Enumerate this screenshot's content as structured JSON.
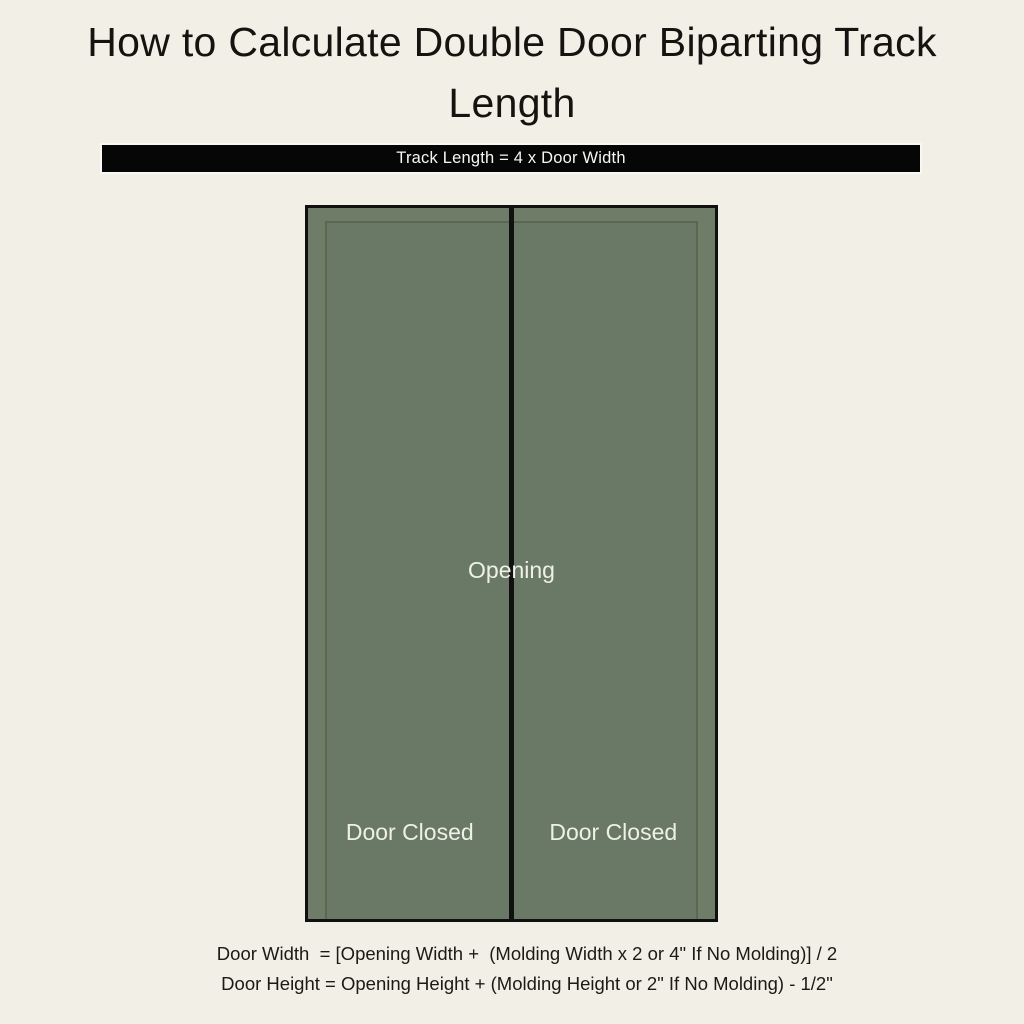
{
  "colors": {
    "page-bg": "#f1efe6",
    "title-color": "#15130f",
    "banner-bg": "#060606",
    "banner-text": "#f7f7f2",
    "door-frame-green": "#6e7c68",
    "door-panel-green": "#6a7965",
    "panel-line-green": "#5a6852",
    "door-outline": "#101010",
    "door-label-color": "#eff0e7",
    "formula-color": "#1c1a16"
  },
  "header": {
    "title": "How to Calculate Double Door Biparting Track Length"
  },
  "banner": {
    "label": "Track Length = 4 x Door Width"
  },
  "diagram": {
    "opening_label": "Opening",
    "doors": [
      {
        "label": "Door Closed"
      },
      {
        "label": "Door Closed"
      }
    ]
  },
  "formulas": {
    "door_width": "Door Width  = [Opening Width +  (Molding Width x 2 or 4\" If No Molding)] / 2",
    "door_height": "Door Height = Opening Height + (Molding Height or 2\" If No Molding) - 1/2\""
  }
}
